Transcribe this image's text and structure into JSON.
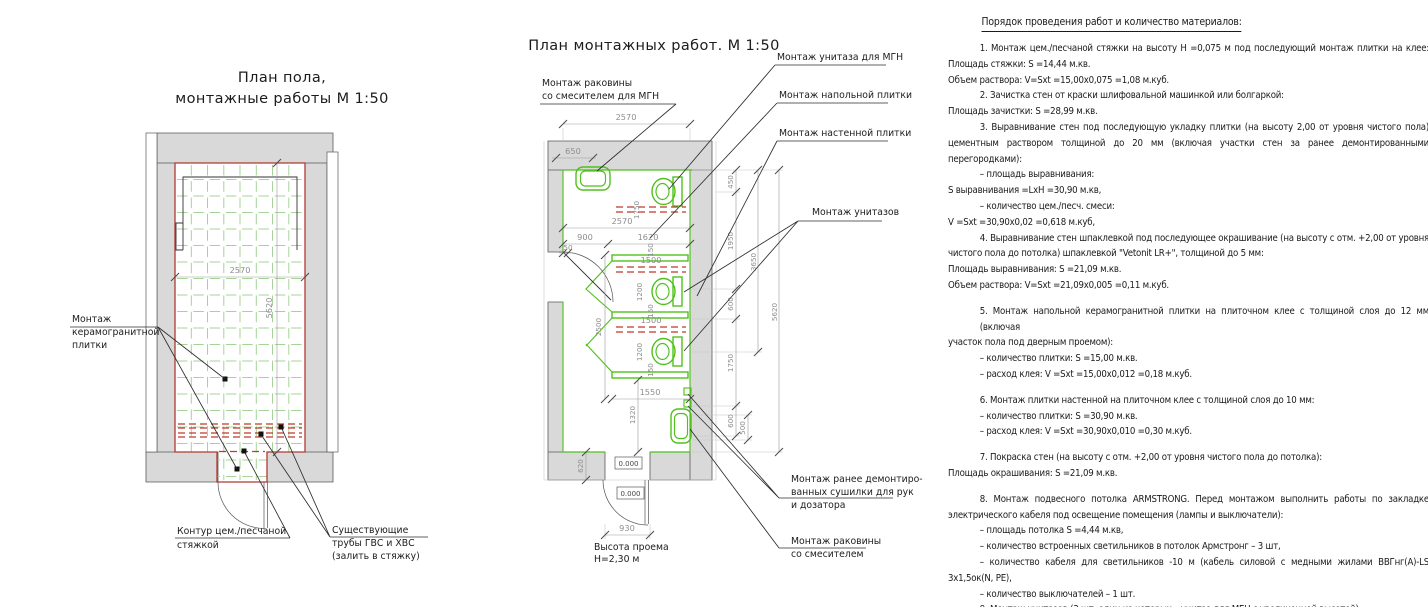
{
  "colors": {
    "fixture_green": "#4fc11c",
    "tile_grid_green": "#a5d398",
    "screed_red": "#b03a2e",
    "wall_gray": "#d9d9d9",
    "dim_gray": "#8e8e8e",
    "text_black": "#1c1c1c"
  },
  "left_plan": {
    "title": [
      "План пола,",
      "монтажные работы М 1:50"
    ],
    "labels": {
      "tile": [
        "Монтаж",
        "керамогранитной",
        "плитки"
      ],
      "contour": [
        "Контур цем./песчаной",
        "стяжкой"
      ],
      "pipes": [
        "Существующие",
        "трубы ГВС и ХВС",
        "(залить в стяжку)"
      ]
    },
    "dims": {
      "width": "2570",
      "height": "5620"
    }
  },
  "mid_plan": {
    "title": "План монтажных работ. М 1:50",
    "labels": {
      "sink_mgn": [
        "Монтаж раковины",
        "со смесителем для МГН"
      ],
      "wc_mgn": "Монтаж унитаза для МГН",
      "floor_tile": "Монтаж напольной плитки",
      "wall_tile": "Монтаж настенной плитки",
      "wcs": "Монтаж унитазов",
      "dryer": [
        "Монтаж ранее демонтиро-",
        "ванных сушилки для рук",
        "и дозатора"
      ],
      "sink": [
        "Монтаж раковины",
        "со смесителем"
      ],
      "door_height": [
        "Высота проема",
        "Н=2,30 м"
      ]
    },
    "dims": {
      "top_width": "2570",
      "d650": "650",
      "inner_width": "2570",
      "d900": "900",
      "d1620": "1620",
      "d50": "50",
      "bar_len": "1750",
      "d150": "150",
      "stall_w": "1500",
      "stall_d": "1200",
      "d1550": "1550",
      "d1320": "1320",
      "left_h": "2500",
      "r450": "450",
      "r1950": "1950",
      "d600": "600",
      "r1750": "1750",
      "r3650": "3650",
      "r5620": "5620",
      "r500": "500",
      "d620": "620",
      "door_w": "930",
      "level": "0.000"
    }
  },
  "worklist": {
    "title": "Порядок проведения работ и количество материалов:",
    "lines": [
      "1.  Монтаж цем./песчаной стяжки на высоту Н =0,075 м под последующий монтаж плитки на клее:",
      "Площадь стяжки: S =14,44 м.кв.",
      "Объем раствора: V=Sxt =15,00х0,075 =1,08 м.куб.",
      "2. Зачистка стен от краски шлифовальной машинкой или болгаркой:",
      "Площадь зачистки: S =28,99 м.кв.",
      "3. Выравнивание стен под последующую укладку плитки (на высоту 2,00 от уровня чистого пола)",
      "цементным раствором толщиной до 20 мм (включая участки стен за ранее демонтированными",
      "перегородками):",
      "– площадь выравнивания:",
      "S выравнивания =LxH =30,90 м.кв,",
      "– количество цем./песч. смеси:",
      "V =Sxt =30,90х0,02 =0,618 м.куб,",
      "4. Выравнивание стен шпаклевкой под последующее  окрашивание (на высоту с отм. +2,00 от уровня",
      "чистого пола до потолка) шпаклевкой \"Vetonit LR+\", толщиной до 5 мм:",
      "Площадь выравнивания: S =21,09 м.кв.",
      "Объем раствора: V=Sxt =21,09х0,005 =0,11 м.куб.",
      "5. Монтаж напольной керамогранитной плитки на плиточном клее с толщиной слоя до 12 мм (включая",
      "участок пола под дверным проемом):",
      "– количество плитки: S =15,00 м.кв.",
      "– расход клея: V =Sxt =15,00х0,012 =0,18 м.куб.",
      "6. Монтаж плитки настенной на плиточном клее с толщиной слоя до 10 мм:",
      "– количество плитки: S =30,90 м.кв.",
      "– расход клея: V =Sxt =30,90х0,010 =0,30 м.куб.",
      "7. Покраска стен (на высоту с отм. +2,00 от уровня чистого пола до потолка):",
      "Площадь окрашивания: S =21,09 м.кв.",
      "8.   Монтаж подвесного потолка ARMSTRONG. Перед монтажом выполнить работы по закладке",
      "электрического кабеля под освещение помещения (лампы и выключатели):",
      "– площадь потолка S =4,44 м.кв,",
      "– количество встроенных светильников в потолок Армстронг – 3 шт,",
      "– количество кабеля для светильников -10 м (кабель силовой с медными жилами ВВГнг(А)-LS",
      "3х1,5ок(N, PE),",
      "– количество выключателей – 1 шт.",
      "9. Монтаж унитазов (3 шт, один из которых – унитаз для МГН с увеличенной высотой)."
    ]
  }
}
